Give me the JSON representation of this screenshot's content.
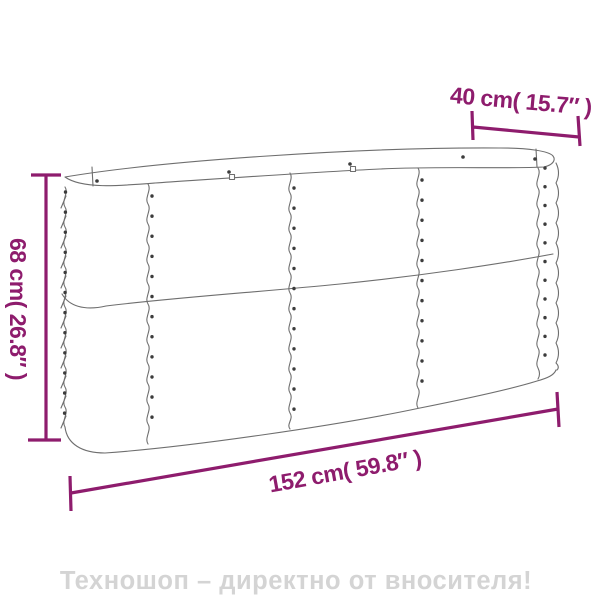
{
  "product_diagram": {
    "type": "raised-garden-bed-dimension-diagram",
    "dimensions": {
      "top_width_label": "40 cm( 15.7″ )",
      "height_label": "68 cm( 26.8″ )",
      "length_label": "152 cm( 59.8″ )"
    },
    "watermark_text": "Техношоп – директно от вносителя!"
  },
  "colors": {
    "dimension_accent": "#8e1c6d",
    "outline_gray": "#6e6e6e",
    "rivet_dark": "#3c3c3c",
    "watermark_gray": "#d4d4d4",
    "background": "#ffffff"
  }
}
